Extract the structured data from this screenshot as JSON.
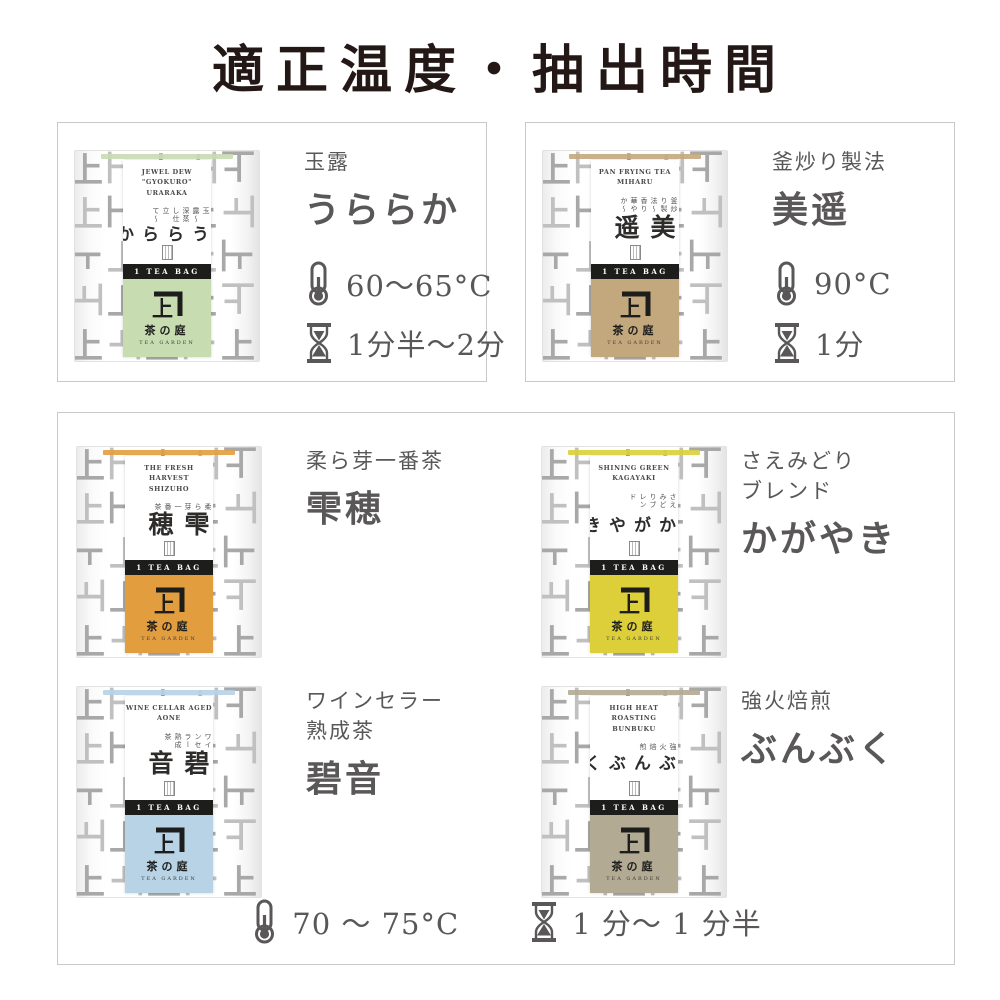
{
  "page": {
    "title": "適正温度・抽出時間"
  },
  "icons": {
    "temperature": "thermometer-icon",
    "time": "hourglass-icon",
    "brand_logo": "kaneju-mark-icon"
  },
  "shared": {
    "tea_bag_label": "1 TEA BAG",
    "brand_name": "茶の庭",
    "brand_sub": "TEA GARDEN",
    "pattern_glyph": "上"
  },
  "products": [
    {
      "id": "uraraka",
      "eng_lines": [
        "JEWEL DEW \"GYOKURO\"",
        "URARAKA"
      ],
      "side_note": "玉露〜深蒸し仕立て〜",
      "vertical_name": "うららか",
      "label_lines": [
        "玉露"
      ],
      "label_name": "うららか",
      "color": "#c8dcb2",
      "temperature": "60〜65°C",
      "time": "1分半〜2分"
    },
    {
      "id": "miharu",
      "eng_lines": [
        "PAN FRYING TEA",
        "MIHARU"
      ],
      "side_note": "釜炒り製法〜香り華やか〜",
      "vertical_name": "美遥",
      "label_lines": [
        "釜炒り製法"
      ],
      "label_name": "美遥",
      "color": "#c4a87d",
      "temperature": "90°C",
      "time": "1分"
    },
    {
      "id": "shizuho",
      "eng_lines": [
        "THE FRESH HARVEST",
        "SHIZUHO"
      ],
      "side_note": "柔ら芽一番茶",
      "vertical_name": "雫穂",
      "label_lines": [
        "柔ら芽一番茶"
      ],
      "label_name": "雫穂",
      "color": "#e29d3e"
    },
    {
      "id": "kagayaki",
      "eng_lines": [
        "SHINING GREEN",
        "KAGAYAKI"
      ],
      "side_note": "さえみどりブレンド",
      "vertical_name": "かがやき",
      "label_lines": [
        "さえみどり",
        "ブレンド"
      ],
      "label_name": "かがやき",
      "color": "#dccf3a"
    },
    {
      "id": "aone",
      "eng_lines": [
        "WINE CELLAR AGED",
        "AONE"
      ],
      "side_note": "ワインセラー熟成茶",
      "vertical_name": "碧音",
      "label_lines": [
        "ワインセラー",
        "熟成茶"
      ],
      "label_name": "碧音",
      "color": "#b7d3e5"
    },
    {
      "id": "bunbuku",
      "eng_lines": [
        "HIGH HEAT ROASTING",
        "BUNBUKU"
      ],
      "side_note": "強火焙煎",
      "vertical_name": "ぶんぶく",
      "label_lines": [
        "強火焙煎"
      ],
      "label_name": "ぶんぶく",
      "color": "#b3aa94"
    }
  ],
  "shared_brewing": {
    "temperature": "70 〜 75°C",
    "time": "1 分〜 1 分半"
  }
}
